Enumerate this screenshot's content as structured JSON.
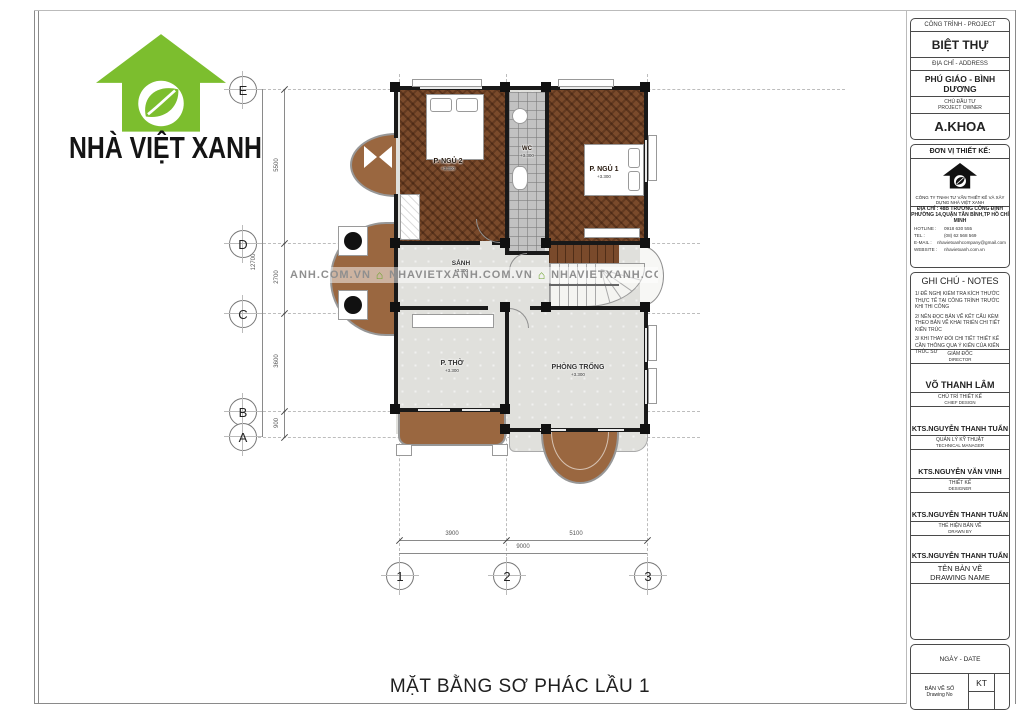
{
  "logo": {
    "brand": "NHÀ VIỆT XANH"
  },
  "watermark": {
    "icon": "⌂",
    "segments": [
      "ANH.COM.VN",
      "NHAVIETXANH.COM.VN",
      "NHAVIETXANH.COM"
    ]
  },
  "plan": {
    "title": "MẶT BẰNG SƠ PHÁC LẦU 1",
    "rooms": [
      {
        "name": "P. NGỦ 2",
        "elev": "+3.300"
      },
      {
        "name": "WC",
        "elev": "+3.300"
      },
      {
        "name": "P. NGỦ 1",
        "elev": "+3.300"
      },
      {
        "name": "SẢNH",
        "elev": "+3.300"
      },
      {
        "name": "P. THỜ",
        "elev": "+3.300"
      },
      {
        "name": "PHÒNG TRỐNG",
        "elev": "+3.300"
      }
    ],
    "grid_rows": [
      "E",
      "D",
      "C",
      "B",
      "A"
    ],
    "grid_cols": [
      "1",
      "2",
      "3"
    ],
    "dims_v": [
      "5500",
      "2700",
      "3600",
      "900"
    ],
    "dim_v_total": "12700",
    "dims_h": [
      "3900",
      "5100"
    ],
    "dim_h_total": "9000"
  },
  "titleblock": {
    "project_label": "CÔNG TRÌNH - PROJECT",
    "project": "BIỆT THỰ",
    "address_label": "ĐỊA CHỈ - ADDRESS",
    "address": "PHÚ GIÁO - BÌNH DƯƠNG",
    "owner_label_vi": "CHỦ ĐẦU TƯ",
    "owner_label_en": "PROJECT OWNER",
    "owner": "A.KHOA",
    "unit_label": "ĐƠN VỊ THIẾT KẾ:",
    "company": "CÔNG TY TNHH TƯ VẤN THIẾT KẾ VÀ XÂY DỰNG NHÀ VIỆT XANH",
    "company_addr1": "ĐỊA CHỈ : 48B TRƯƠNG CÔNG ĐỊNH",
    "company_addr2": "PHƯỜNG 14,QUẬN TÂN BÌNH,TP HỒ CHÍ MINH",
    "contacts": [
      {
        "label": "HOTLINE :",
        "value": "0918 630 555"
      },
      {
        "label": "TEL :",
        "value": "(08) 62 568 569"
      },
      {
        "label": "E-MAIL :",
        "value": "nhavietxanhcompany@gmail.com"
      },
      {
        "label": "WEBSITE :",
        "value": "nhavietxanh.com.vn"
      }
    ],
    "notes_title": "GHI CHÚ - NOTES",
    "notes": [
      "1/ ĐỀ NGHỊ KIỂM TRA KÍCH THƯỚC THỰC TẾ TẠI CÔNG TRÌNH TRƯỚC KHI THI CÔNG",
      "2/ NÊN ĐỌC BẢN VẼ KẾT CẤU KÈM THEO BẢN VẼ KHAI TRIỂN CHI TIẾT KIẾN TRÚC",
      "3/ KHI THAY ĐỔI CHI TIẾT THIẾT KẾ CẦN THÔNG QUA Ý KIẾN CỦA KIẾN TRÚC SƯ"
    ],
    "roles": [
      {
        "vi": "GIÁM ĐỐC",
        "en": "DIRECTOR",
        "name": "VÕ THANH LÂM"
      },
      {
        "vi": "CHỦ TRÌ THIẾT KẾ",
        "en": "CHIEF DESIGN",
        "name": "KTS.NGUYỄN THANH TUẤN"
      },
      {
        "vi": "QUẢN LÝ KỸ THUẬT",
        "en": "TECHNICAL MANAGER",
        "name": "KTS.NGUYỄN VĂN VINH"
      },
      {
        "vi": "THIẾT KẾ",
        "en": "DESIGNER",
        "name": "KTS.NGUYỄN THANH TUẤN"
      },
      {
        "vi": "THỂ HIỆN BẢN VẼ",
        "en": "DRAWN BY",
        "name": "KTS.NGUYỄN THANH TUẤN"
      }
    ],
    "drawing_name_vi": "TÊN BẢN VẼ",
    "drawing_name_en": "DRAWING NAME",
    "date_label": "NGÀY - DATE",
    "no_vi": "BẢN VẼ SỐ",
    "no_en": "Drawing No",
    "no_value": "KT"
  }
}
